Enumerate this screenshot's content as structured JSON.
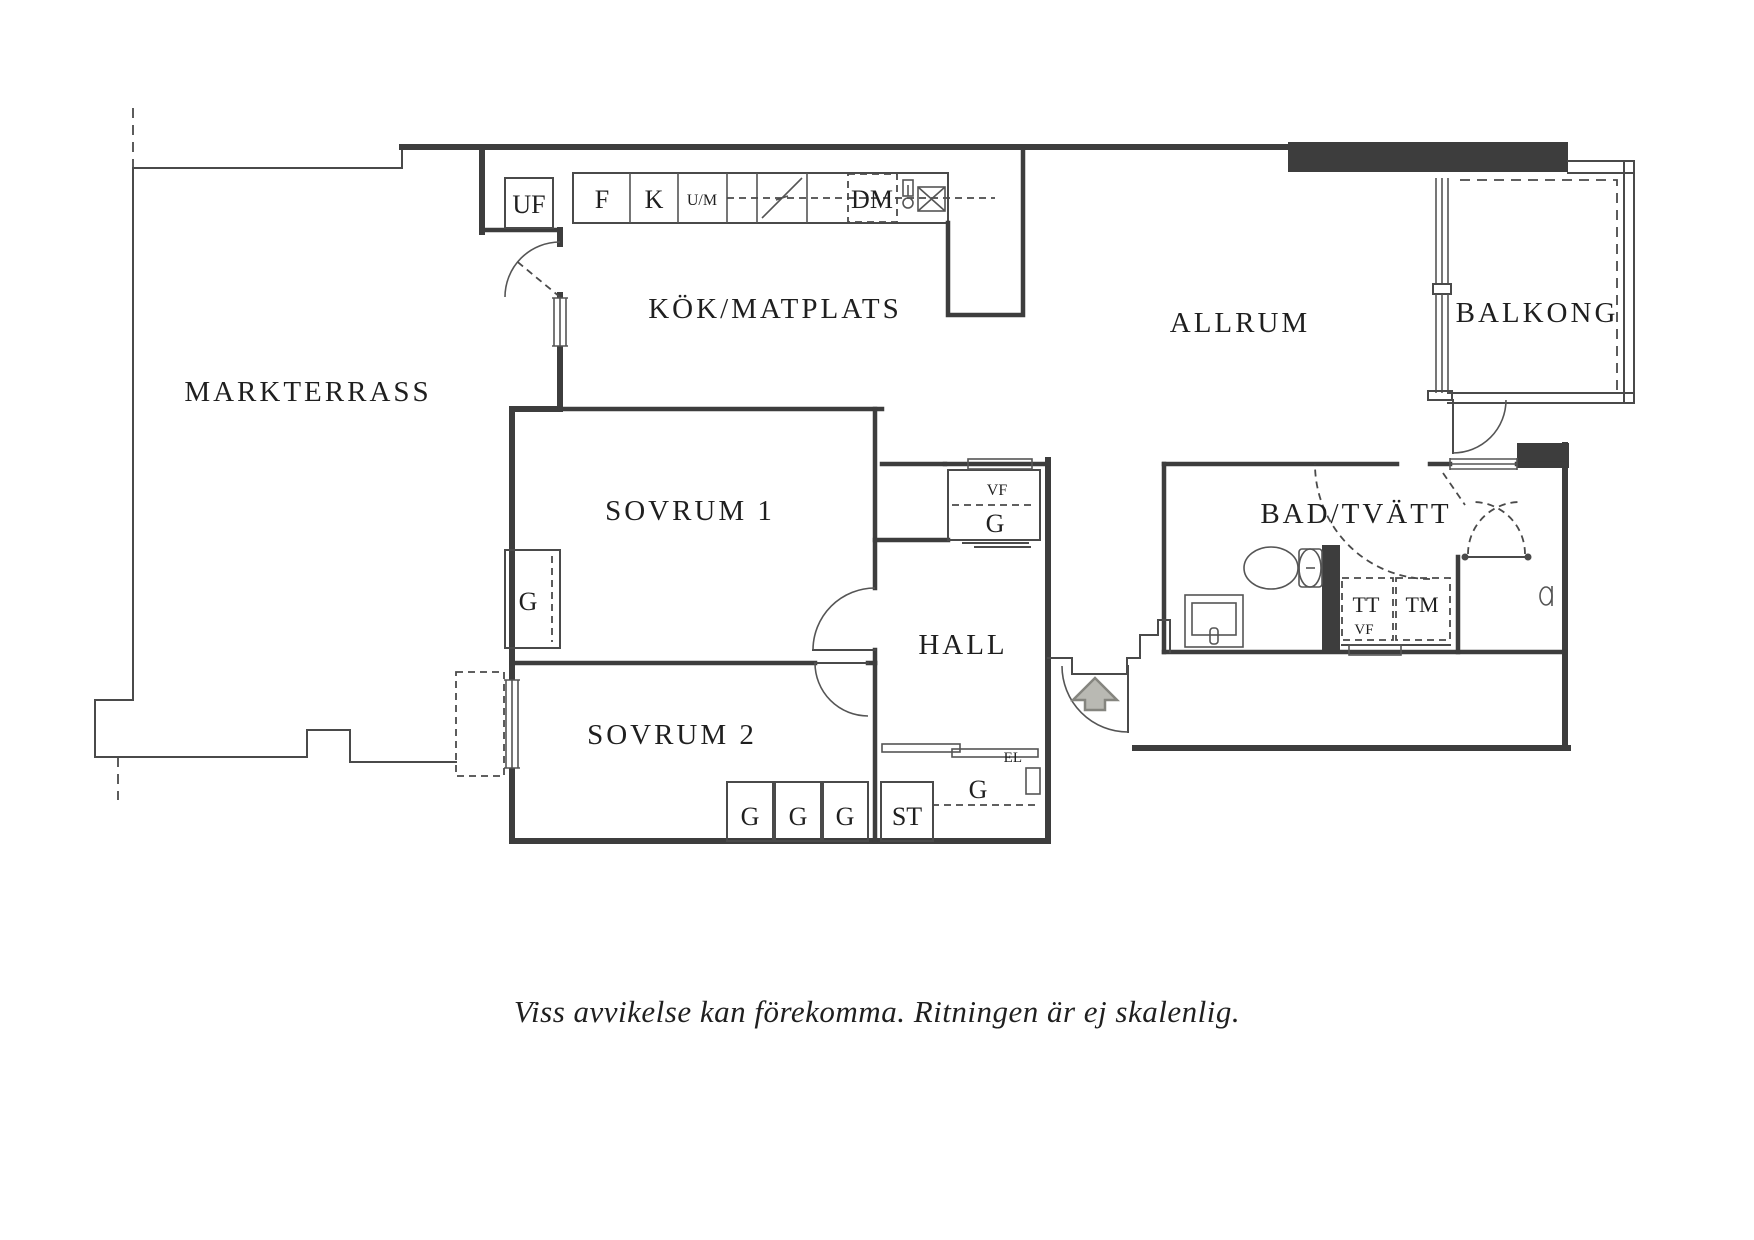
{
  "rooms": {
    "markterrass": "MARKTERRASS",
    "kok_matplats": "KÖK/MATPLATS",
    "allrum": "ALLRUM",
    "balkong": "BALKONG",
    "sovrum1": "SOVRUM 1",
    "sovrum2": "SOVRUM 2",
    "hall": "HALL",
    "bad_tvatt": "BAD/TVÄTT"
  },
  "kitchen": {
    "uf": "UF",
    "f": "F",
    "k": "K",
    "um": "U/M",
    "dm": "DM"
  },
  "storage": {
    "vf": "VF",
    "g": "G",
    "st": "ST",
    "el": "EL"
  },
  "laundry": {
    "tt": "TT",
    "tm": "TM",
    "vf": "VF"
  },
  "caption": "Viss avvikelse kan förekomma. Ritningen är ej skalenlig.",
  "colors": {
    "wall": "#3d3d3d",
    "thin_line": "#555555",
    "text": "#1f1f1f",
    "arrow_fill": "#b9b9b3",
    "arrow_stroke": "#85857f",
    "background": "#ffffff"
  }
}
